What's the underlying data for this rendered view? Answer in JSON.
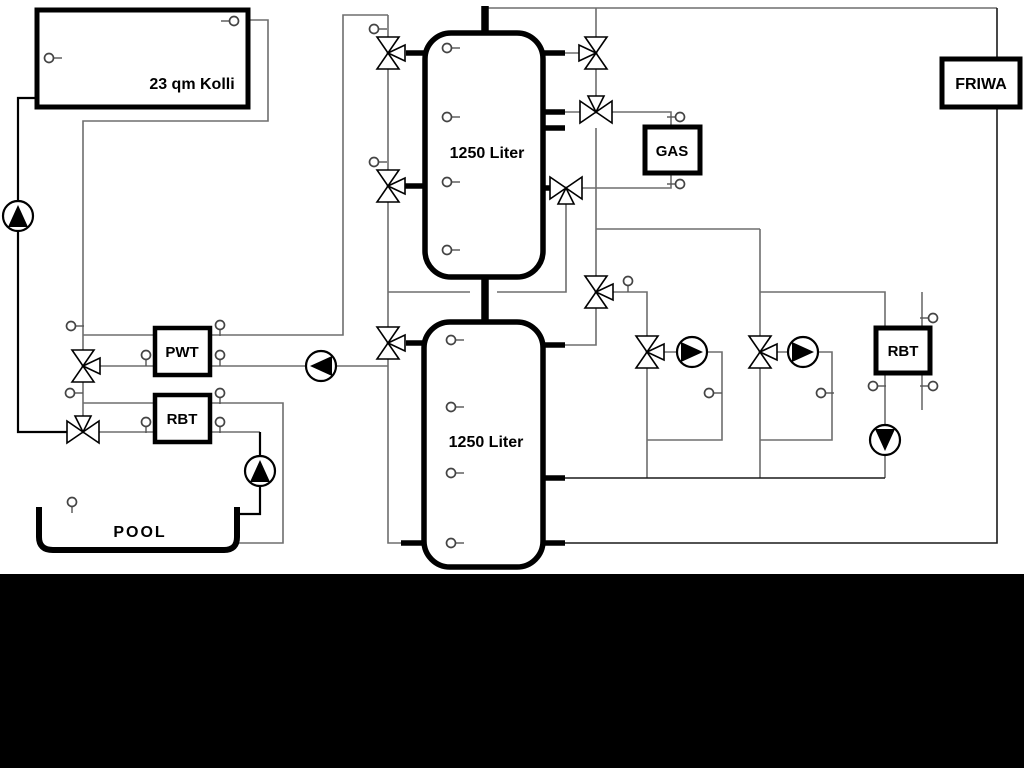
{
  "diagram": {
    "type": "heating-solar-pool-hydraulic-schematic",
    "labels": {
      "collector": "23 qm Kolli",
      "buffer_tank_top": "1250 Liter",
      "buffer_tank_bottom": "1250 Liter",
      "heat_exchanger": "PWT",
      "return_unit_left": "RBT",
      "boiler": "GAS",
      "fresh_water_station": "FRIWA",
      "return_unit_right": "RBT",
      "pool": "POOL"
    },
    "colors": {
      "background": "#ffffff",
      "pipe_gray": "#6e6e6e",
      "pipe_black": "#000000",
      "component_stroke": "#000000",
      "bottom_bar": "#000000"
    }
  }
}
